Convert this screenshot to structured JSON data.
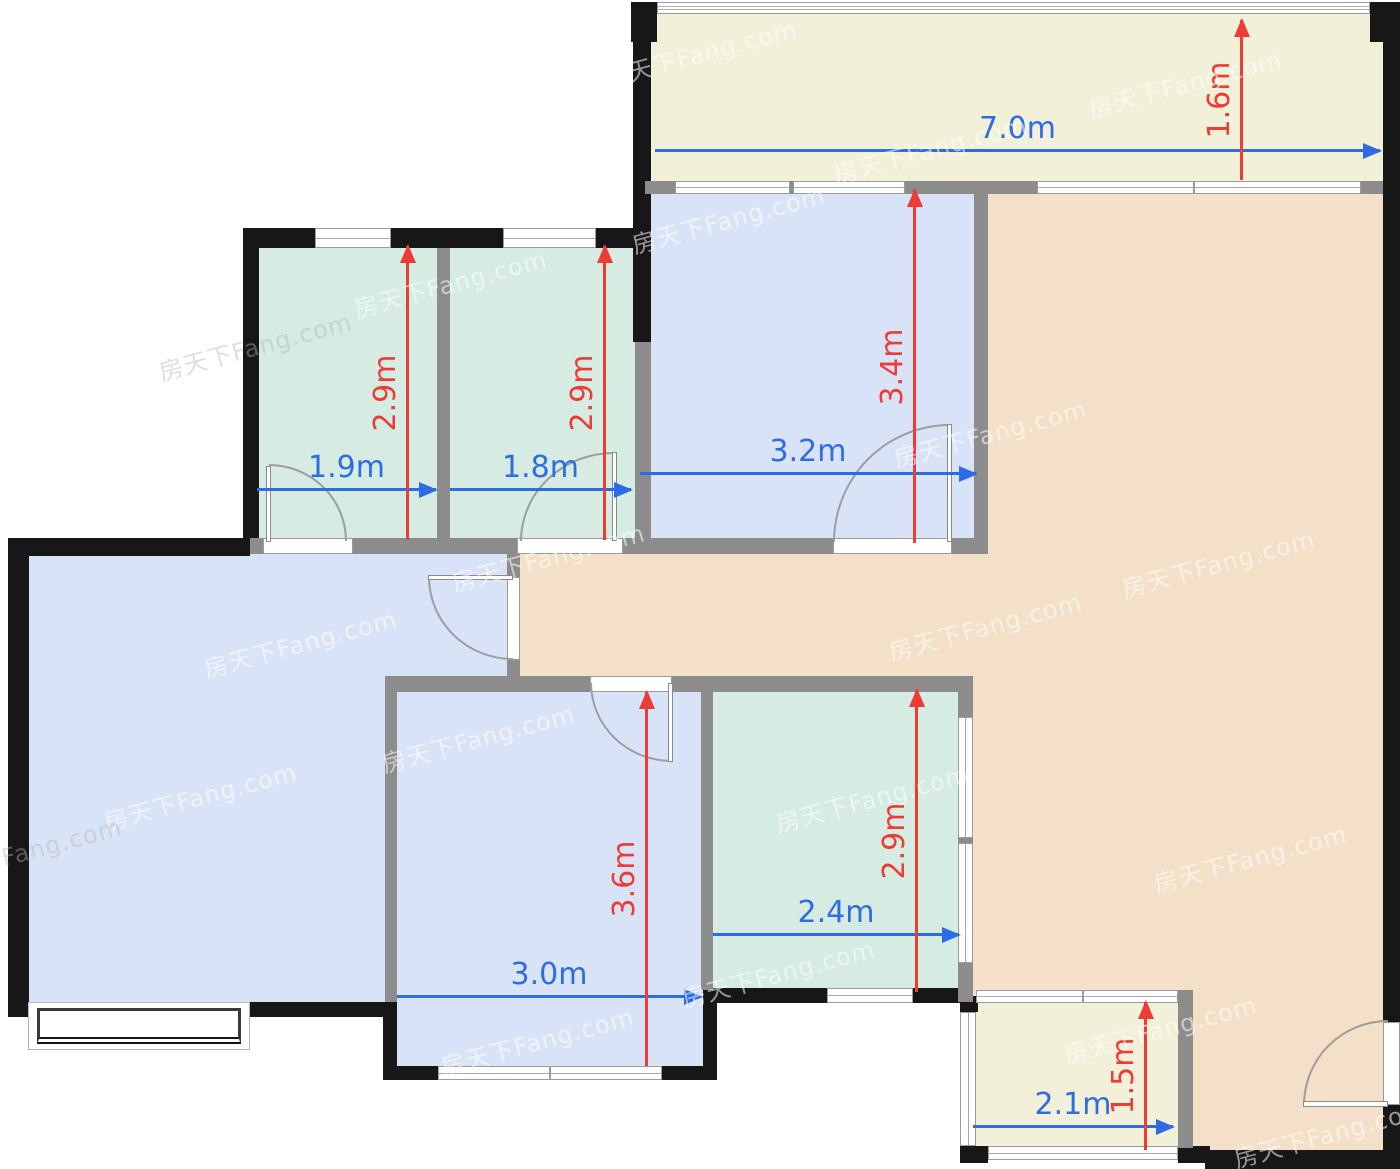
{
  "watermark": {
    "text": "房天下Fang.com"
  },
  "palette": {
    "floor_blue": "#d9e3f8",
    "floor_green": "#d6ebe2",
    "floor_peach": "#f4dfc8",
    "floor_cream": "#f2f0d8",
    "wall_dark": "#171717",
    "wall_gray": "#8c8c8c",
    "dim_blue": "#2e6ce6",
    "dim_red": "#ee3b33"
  },
  "dimensions": {
    "balcony_top": {
      "width": "7.0m",
      "depth": "1.6m"
    },
    "room_top_left": {
      "width": "1.9m",
      "depth": "2.9m"
    },
    "room_top_mid": {
      "width": "1.8m",
      "depth": "2.9m"
    },
    "room_top_right": {
      "width": "3.2m",
      "depth": "3.4m"
    },
    "room_bottom_mid": {
      "width": "3.0m",
      "depth": "3.6m"
    },
    "room_bottom_green": {
      "width": "2.4m",
      "depth": "2.9m"
    },
    "balcony_bottom": {
      "width": "2.1m",
      "depth": "1.5m"
    }
  }
}
